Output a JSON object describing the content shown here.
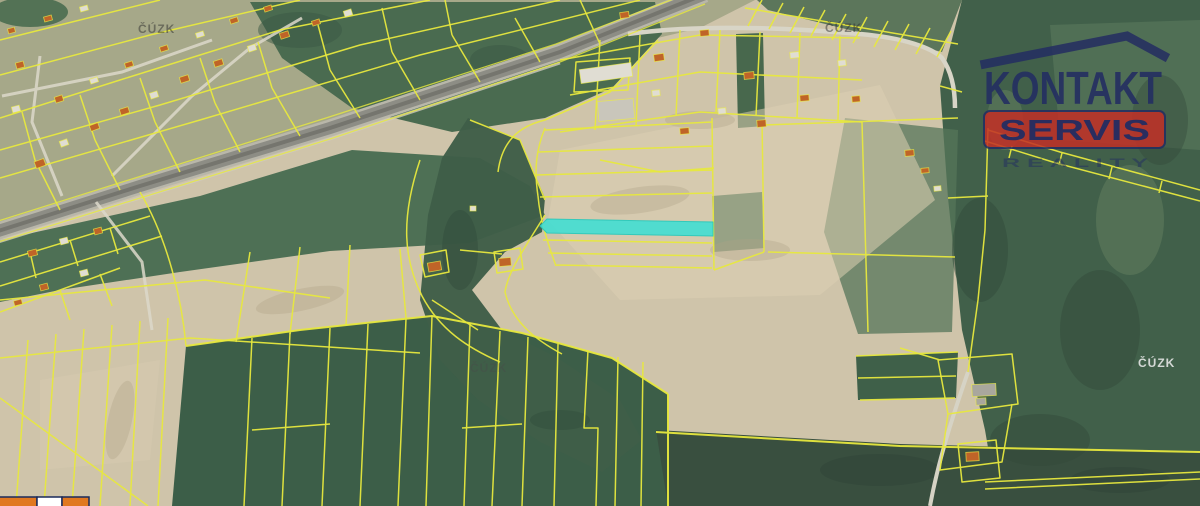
{
  "logo": {
    "kontakt": "KONTAKT",
    "servis": "SERVIS",
    "reality": "R E A L I T Y",
    "navy": "#232d62",
    "red": "#c22f26"
  },
  "map": {
    "parcel_line_color": "#e7e83e",
    "highlighted_parcel": {
      "fill": "#45ded2"
    },
    "watermarks": [
      {
        "text": "ČÚZK",
        "variant": "dark"
      },
      {
        "text": "ČÚZK",
        "variant": "dark"
      },
      {
        "text": "ČÚZK",
        "variant": "faint"
      },
      {
        "text": "ČÚZK",
        "variant": "light"
      }
    ]
  },
  "scalebar": {
    "orange": "#e07820",
    "white": "#ffffff",
    "border": "#1a2a5a"
  }
}
